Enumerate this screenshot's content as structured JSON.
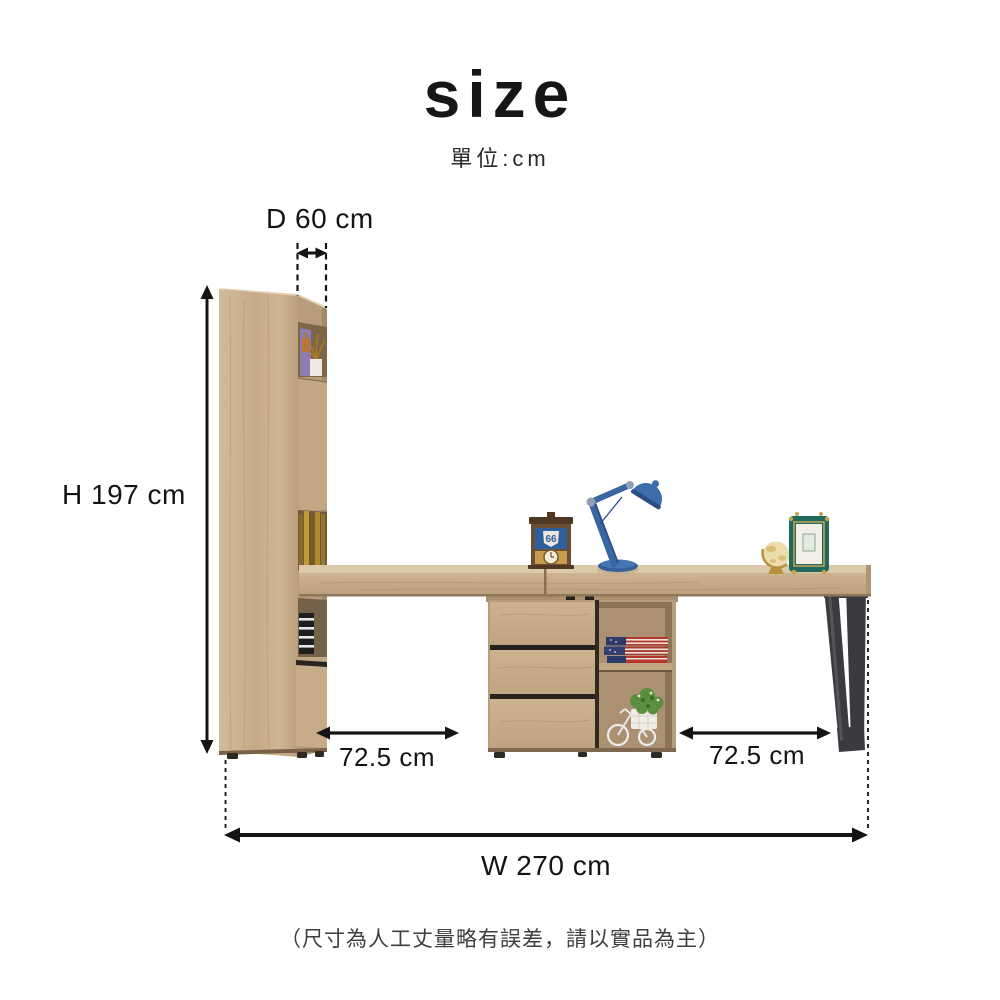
{
  "page": {
    "title": "size",
    "unit_note": "單位:cm",
    "disclaimer": "（尺寸為人工丈量略有誤差，請以實品為主）"
  },
  "dimensions": {
    "depth": "D 60 cm",
    "height": "H 197 cm",
    "left_desk_span": "72.5 cm",
    "right_desk_span": "72.5 cm",
    "total_width": "W 270 cm"
  },
  "decor": {
    "clock_badge": "66"
  },
  "furniture": {
    "parts": [
      "tall-bookcase",
      "desk-top",
      "three-drawer-cabinet",
      "open-shelf-cubby",
      "metal-sled-leg"
    ],
    "props": [
      "desk-lamp",
      "table-clock",
      "mini-globe",
      "photo-frame",
      "gold-books",
      "flag-books",
      "striped-box",
      "plant-tricycle",
      "dried-plant"
    ]
  },
  "palette": {
    "background": "#ffffff",
    "annotation": "#141414",
    "wood_light": "#dcc9a9",
    "wood_main": "#c8ae8d",
    "wood_deep": "#a98e6e",
    "wood_shadow": "#8d7458",
    "metal_leg": "#3b3a3e",
    "lamp_blue": "#3a66a2",
    "clock_blue": "#2e5f9e",
    "frame_teal": "#20695e",
    "gold": "#c9a24b",
    "plant_green": "#5a8f3f"
  }
}
